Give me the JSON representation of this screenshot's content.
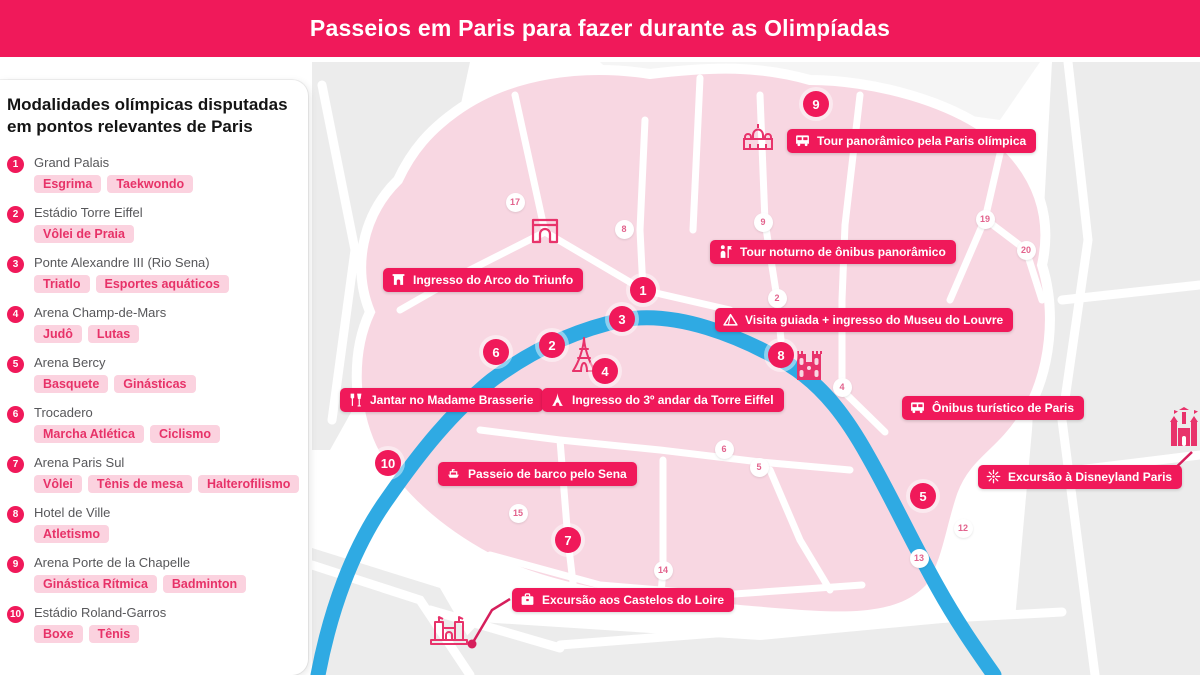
{
  "header": {
    "title": "Passeios em Paris para fazer durante as Olimpíadas"
  },
  "colors": {
    "accent": "#f0195a",
    "tag_bg": "#fbd2df",
    "tag_text": "#e73268",
    "map_pink": "#f8d7e2",
    "outside_gray": "#ececec",
    "river_blue": "#2faae3",
    "district_text": "#e2638d",
    "landmark_pink": "#e8336b"
  },
  "sidebar": {
    "title_line1": "Modalidades olímpicas disputadas",
    "title_line2": "em pontos relevantes de Paris",
    "items": [
      {
        "number": "1",
        "name": "Grand Palais",
        "tags": [
          "Esgrima",
          "Taekwondo"
        ]
      },
      {
        "number": "2",
        "name": "Estádio Torre Eiffel",
        "tags": [
          "Vôlei de Praia"
        ]
      },
      {
        "number": "3",
        "name": "Ponte Alexandre III (Rio Sena)",
        "tags": [
          "Triatlo",
          "Esportes aquáticos"
        ]
      },
      {
        "number": "4",
        "name": "Arena Champ-de-Mars",
        "tags": [
          "Judô",
          "Lutas"
        ]
      },
      {
        "number": "5",
        "name": "Arena Bercy",
        "tags": [
          "Basquete",
          "Ginásticas"
        ]
      },
      {
        "number": "6",
        "name": "Trocadero",
        "tags": [
          "Marcha Atlética",
          "Ciclismo"
        ]
      },
      {
        "number": "7",
        "name": "Arena Paris Sul",
        "tags": [
          "Vôlei",
          "Tênis de mesa",
          "Halterofilismo"
        ]
      },
      {
        "number": "8",
        "name": "Hotel de Ville",
        "tags": [
          "Atletismo"
        ]
      },
      {
        "number": "9",
        "name": "Arena Porte de la Chapelle",
        "tags": [
          "Ginástica Rítmica",
          "Badminton"
        ]
      },
      {
        "number": "10",
        "name": "Estádio Roland-Garros",
        "tags": [
          "Boxe",
          "Tênis"
        ]
      }
    ]
  },
  "map": {
    "labels": [
      {
        "icon": "arch-icon",
        "text": "Ingresso do Arco do Triunfo",
        "x": 383,
        "y": 268
      },
      {
        "icon": "bus-icon",
        "text": "Tour panorâmico pela Paris olímpica",
        "x": 787,
        "y": 129
      },
      {
        "icon": "person-flag-icon",
        "text": "Tour noturno de ônibus panorâmico",
        "x": 710,
        "y": 240
      },
      {
        "icon": "pyramid-icon",
        "text": "Visita guiada + ingresso do Museu do Louvre",
        "x": 715,
        "y": 308
      },
      {
        "icon": "fork-glass-icon",
        "text": "Jantar no Madame Brasserie",
        "x": 340,
        "y": 388
      },
      {
        "icon": "eiffel-icon",
        "text": "Ingresso do 3º andar da Torre Eiffel",
        "x": 542,
        "y": 388
      },
      {
        "icon": "bus-icon",
        "text": "Ônibus turístico de Paris",
        "x": 902,
        "y": 396
      },
      {
        "icon": "sparkle-icon",
        "text": "Excursão à Disneyland Paris",
        "x": 978,
        "y": 465
      },
      {
        "icon": "boat-icon",
        "text": "Passeio de barco pelo Sena",
        "x": 438,
        "y": 462
      },
      {
        "icon": "briefcase-icon",
        "text": "Excursão aos Castelos do Loire",
        "x": 512,
        "y": 588
      }
    ],
    "venue_markers": [
      {
        "number": "1",
        "x": 643,
        "y": 290
      },
      {
        "number": "2",
        "x": 552,
        "y": 345
      },
      {
        "number": "3",
        "x": 622,
        "y": 319
      },
      {
        "number": "4",
        "x": 605,
        "y": 371
      },
      {
        "number": "5",
        "x": 923,
        "y": 496
      },
      {
        "number": "6",
        "x": 496,
        "y": 352
      },
      {
        "number": "7",
        "x": 568,
        "y": 540
      },
      {
        "number": "8",
        "x": 781,
        "y": 355
      },
      {
        "number": "9",
        "x": 816,
        "y": 104
      },
      {
        "number": "10",
        "x": 388,
        "y": 463
      }
    ],
    "district_markers": [
      {
        "number": "17",
        "x": 515,
        "y": 202
      },
      {
        "number": "8",
        "x": 624,
        "y": 229
      },
      {
        "number": "9",
        "x": 763,
        "y": 222
      },
      {
        "number": "2",
        "x": 777,
        "y": 298
      },
      {
        "number": "19",
        "x": 985,
        "y": 219
      },
      {
        "number": "20",
        "x": 1026,
        "y": 250
      },
      {
        "number": "4",
        "x": 842,
        "y": 387
      },
      {
        "number": "6",
        "x": 724,
        "y": 449
      },
      {
        "number": "5",
        "x": 759,
        "y": 467
      },
      {
        "number": "15",
        "x": 518,
        "y": 513
      },
      {
        "number": "14",
        "x": 663,
        "y": 570
      },
      {
        "number": "12",
        "x": 963,
        "y": 528
      },
      {
        "number": "13",
        "x": 919,
        "y": 558
      }
    ],
    "landmarks": [
      {
        "name": "sacre-coeur",
        "x": 741,
        "y": 120
      },
      {
        "name": "arc-de-triomphe",
        "x": 530,
        "y": 216
      },
      {
        "name": "eiffel-tower",
        "x": 570,
        "y": 336
      },
      {
        "name": "notre-dame",
        "x": 793,
        "y": 348
      },
      {
        "name": "disney-castle",
        "x": 1166,
        "y": 406
      },
      {
        "name": "loire-castle",
        "x": 428,
        "y": 610
      }
    ]
  }
}
